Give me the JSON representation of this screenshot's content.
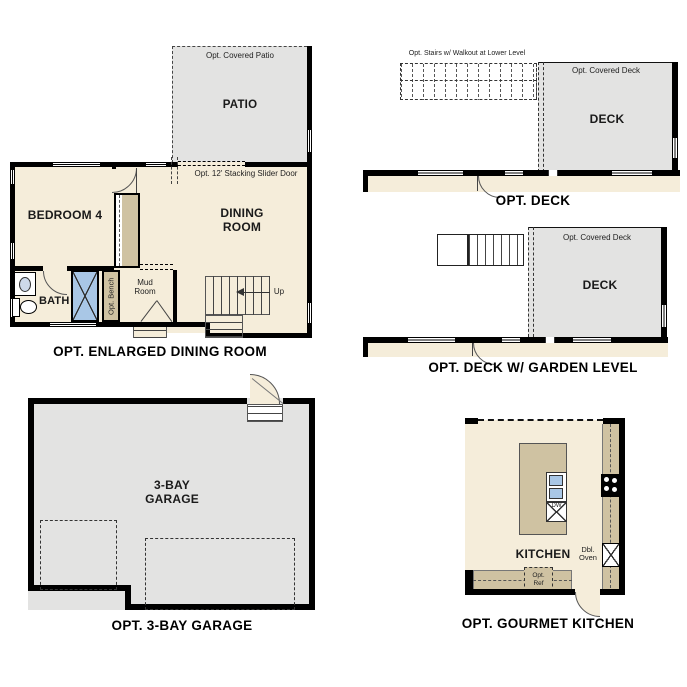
{
  "colors": {
    "floor": "#f5edda",
    "hard": "#e3e3e2",
    "cabinet": "#cfc2a2",
    "fixture": "#a9c7e6",
    "wall": "#000000",
    "line": "#444444"
  },
  "plans": {
    "p1": {
      "title": "OPT. ENLARGED DINING ROOM",
      "patio": "PATIO",
      "covered_patio_note": "Opt. Covered Patio",
      "slider_note": "Opt. 12' Stacking Slider Door",
      "bedroom": "BEDROOM 4",
      "dining": "DINING ROOM",
      "bath": "BATH 4",
      "bench_note": "Opt. Bench",
      "mud": "Mud Room",
      "up": "Up"
    },
    "p2": {
      "title": "OPT. DECK",
      "deck": "DECK",
      "covered_note": "Opt. Covered Deck",
      "stairs_note": "Opt. Stairs w/ Walkout at Lower Level"
    },
    "p3": {
      "title": "OPT. DECK W/ GARDEN LEVEL",
      "deck": "DECK",
      "covered_note": "Opt. Covered Deck"
    },
    "p4": {
      "title": "OPT. 3-BAY GARAGE",
      "room": "3-BAY GARAGE"
    },
    "p5": {
      "title": "OPT. GOURMET KITCHEN",
      "room": "KITCHEN",
      "dw": "DW",
      "oven": "Dbl. Oven",
      "ref": "Opt. Ref"
    }
  }
}
